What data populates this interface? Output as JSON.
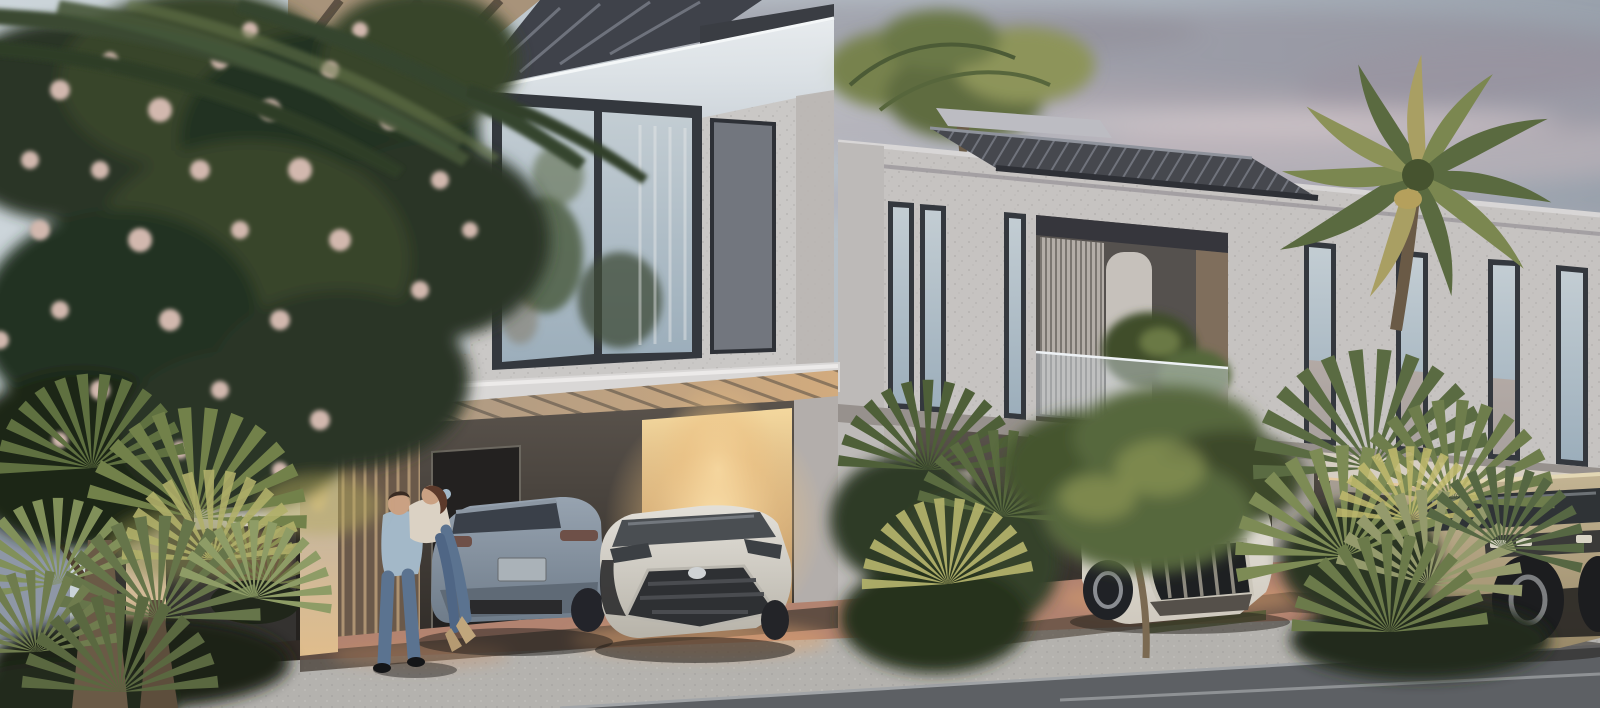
{
  "scene": {
    "type": "architectural-render",
    "description": "Dusk exterior rendering of modern two-storey townhouses with lit carports, parked cars, palms, flowering tree and a couple embracing",
    "time_of_day": "dusk",
    "objects": [
      "dusk sky with pink-gray clouds",
      "flowering tree with pink blossoms",
      "foreground fan palms",
      "left townhouse with glass roof terrace and slatted carport canopy",
      "right townhouse with rooftop pergola and louvered balcony",
      "far-right unit with white door",
      "couple embracing (man lifting woman)",
      "gray SUV coupe (rear view)",
      "white compact crossover (front view)",
      "white luxury SUV in driveway",
      "beige off-road truck",
      "rooftop date palms",
      "red paver driveway",
      "gravel sidewalk",
      "asphalt road"
    ]
  },
  "palette": {
    "sky_left": "#ccd5da",
    "sky_mid": "#b8c1c9",
    "sky_right": "#99a1ac",
    "cloud_dark": "#8f8b97",
    "cloud_pink": "#c5b6bb",
    "wall_light": "#cac8c6",
    "wall_right": "#c6c3c1",
    "wall_pier": "#b7b2ae",
    "frame_dark": "#34383e",
    "glass_top": "#c3cdd3",
    "glass_bottom": "#9caebb",
    "panel_gray": "#72767e",
    "balustrade_top": "#eef2f4",
    "balustrade_bottom": "#b9c3cc",
    "canopy_dark": "#46484e",
    "canopy_fascia": "#dcdad9",
    "warm_core": "#ffe8b4",
    "warm_mid": "#edc284",
    "glow_top": "#f4d89e",
    "glow_bottom": "#a87e55",
    "recess_top": "#5a534c",
    "recess_bottom": "#2e2a26",
    "suv_top": "#97a3b0",
    "suv_bottom": "#6f7c8a",
    "chr_top": "#e3e0d9",
    "chr_bottom": "#b7b3a9",
    "audi_top": "#ece9e2",
    "audi_bottom": "#cfc9be",
    "truck_top": "#c3b493",
    "truck_bottom": "#998968",
    "driveway": "#b28370",
    "sidewalk": "#b4b2ae",
    "road": "#5d6064",
    "foliage_dark": "#2c3626",
    "foliage_mid": "#57683c",
    "foliage_light": "#8a9a64",
    "palm_lit": "#b1b06a",
    "blossom": "#d2b8ae",
    "trunk": "#6a5a46",
    "shirt": "#a3b8c8",
    "jeans": "#5b7390",
    "cream": "#dbd2c4",
    "skin": "#caa183",
    "hair_brown": "#5c3a2b",
    "boots": "#c0a67c"
  }
}
